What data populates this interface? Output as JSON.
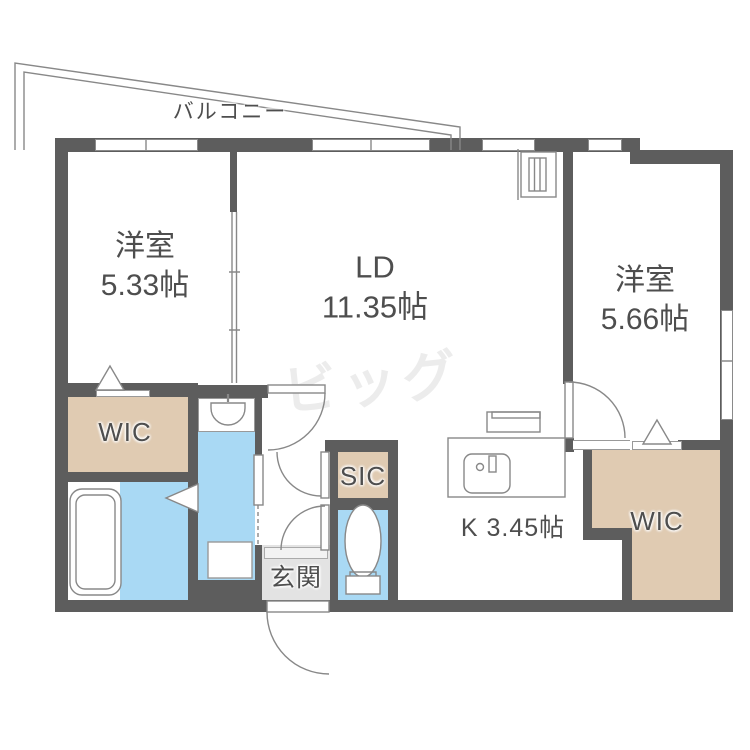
{
  "plan": {
    "balcony_label": "バルコニー",
    "rooms": [
      {
        "name": "洋室",
        "size": "5.33帖"
      },
      {
        "name": "LD",
        "size": "11.35帖"
      },
      {
        "name": "洋室",
        "size": "5.66帖"
      }
    ],
    "labels": {
      "wic_left": "WIC",
      "wic_right": "WIC",
      "sic": "SIC",
      "genkan": "玄関",
      "kitchen": "K 3.45帖"
    },
    "watermark": "ビッグ",
    "colors": {
      "wall": "#5d5d5d",
      "closet_floor": "#e0cbb2",
      "wet_area_floor": "#a9d9f4",
      "genkan_floor": "#e3e3e3",
      "linework": "#888888",
      "text": "#4e4e4e",
      "watermark": "#ececec"
    }
  }
}
